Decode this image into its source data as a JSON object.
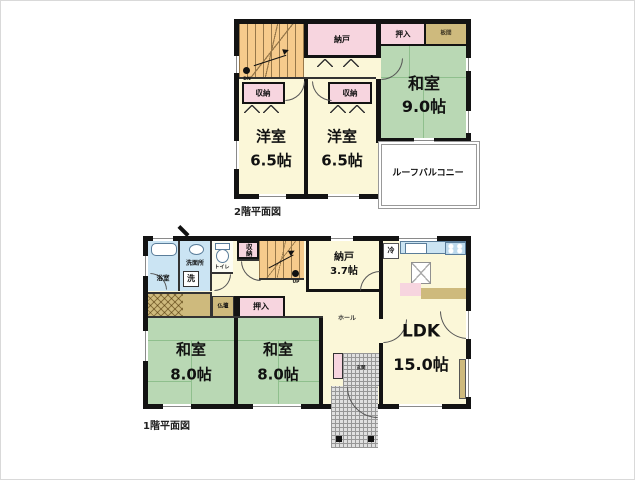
{
  "document": {
    "type": "floor-plan",
    "background": "#ffffff"
  },
  "palette": {
    "wall": "#131313",
    "floor_cream": "#FBF7D8",
    "tatami_green": "#B9D8B4",
    "closet_pink": "#F7D5DF",
    "bath_blue": "#CBE4F3",
    "wood_tan": "#CEBA7D",
    "stairs_orange": "#F6CB8C",
    "balcony_white": "#FFFFFF",
    "hatch_gray": "#979797"
  },
  "floor2": {
    "caption": "2階平面図",
    "stairs": {
      "label": "DN"
    },
    "rooms": {
      "nando": {
        "label": "納戸"
      },
      "oshiire": {
        "label": "押入"
      },
      "itanoma": {
        "label": "板間"
      },
      "washitsu": {
        "label": "和室",
        "area": "9.0帖"
      },
      "youshitsu_left": {
        "label": "洋室",
        "area": "6.5帖"
      },
      "youshitsu_right": {
        "label": "洋室",
        "area": "6.5帖"
      },
      "shuno_left": {
        "label": "収納"
      },
      "shuno_right": {
        "label": "収納"
      },
      "roof_balcony": {
        "label": "ルーフバルコニー"
      }
    }
  },
  "floor1": {
    "caption": "1階平面図",
    "stairs": {
      "label": "UP"
    },
    "rooms": {
      "bath": {
        "label": "浴室"
      },
      "washroom": {
        "label": "洗面所"
      },
      "laundry": {
        "label": "洗"
      },
      "toilet": {
        "label": "トイレ"
      },
      "shuno": {
        "label": "収納"
      },
      "nando": {
        "label": "納戸",
        "area": "3.7帖"
      },
      "butsudan": {
        "label": "仏壇"
      },
      "oshiire": {
        "label": "押入"
      },
      "washitsu_left": {
        "label": "和室",
        "area": "8.0帖"
      },
      "washitsu_right": {
        "label": "和室",
        "area": "8.0帖"
      },
      "hall": {
        "label": "ホール"
      },
      "ldk": {
        "label": "LDK",
        "area": "15.0帖"
      },
      "fridge": {
        "label": "冷"
      },
      "genkan": {
        "label": "玄関"
      }
    }
  }
}
